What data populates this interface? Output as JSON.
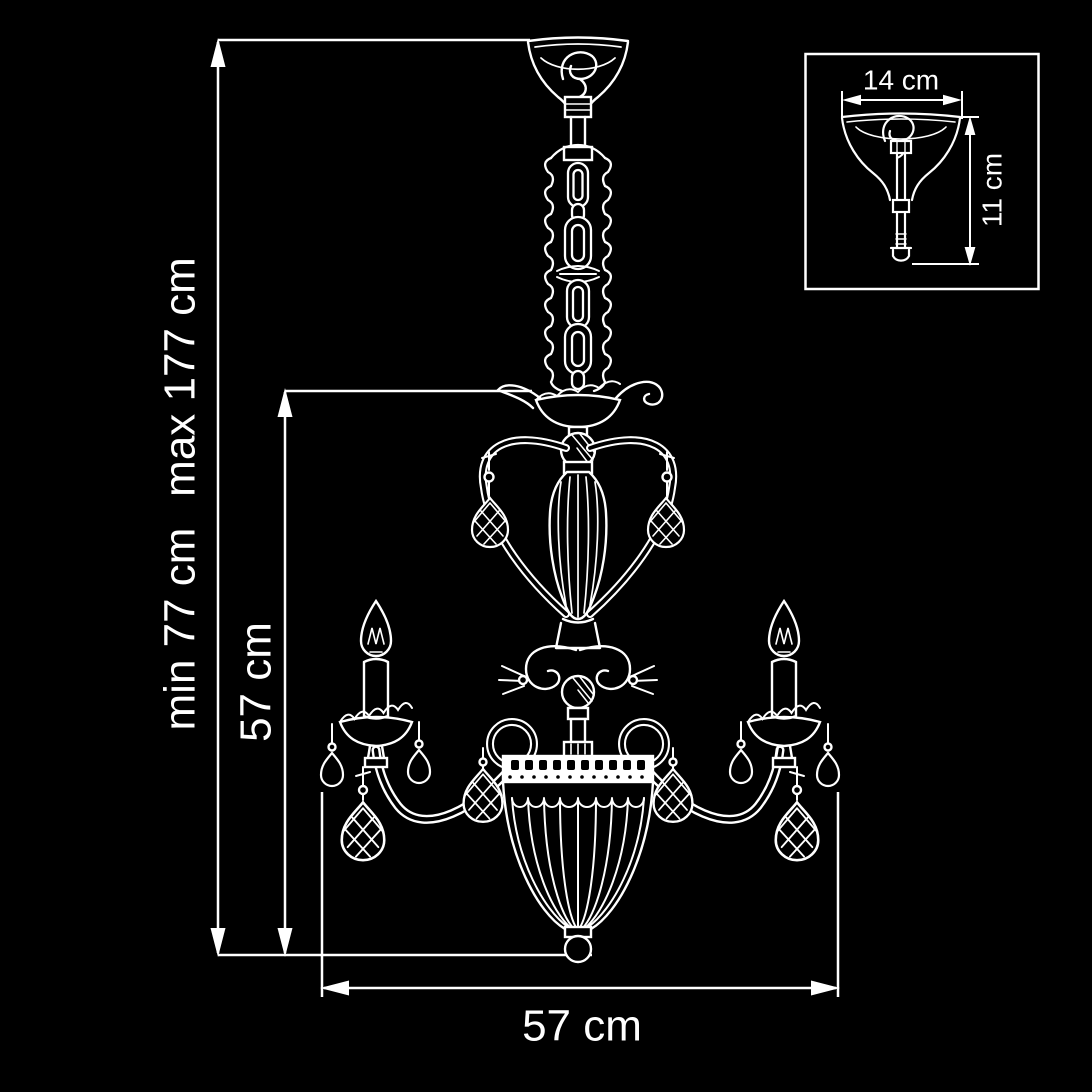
{
  "title": "Chandelier dimension drawing",
  "colors": {
    "background": "#000000",
    "line": "#ffffff",
    "text": "#ffffff"
  },
  "labels": {
    "height_min": "min 77 cm",
    "height_max": "max 177 cm",
    "body_height": "57 cm",
    "body_width": "57 cm",
    "canopy_width": "14 cm",
    "canopy_height": "11 cm"
  }
}
